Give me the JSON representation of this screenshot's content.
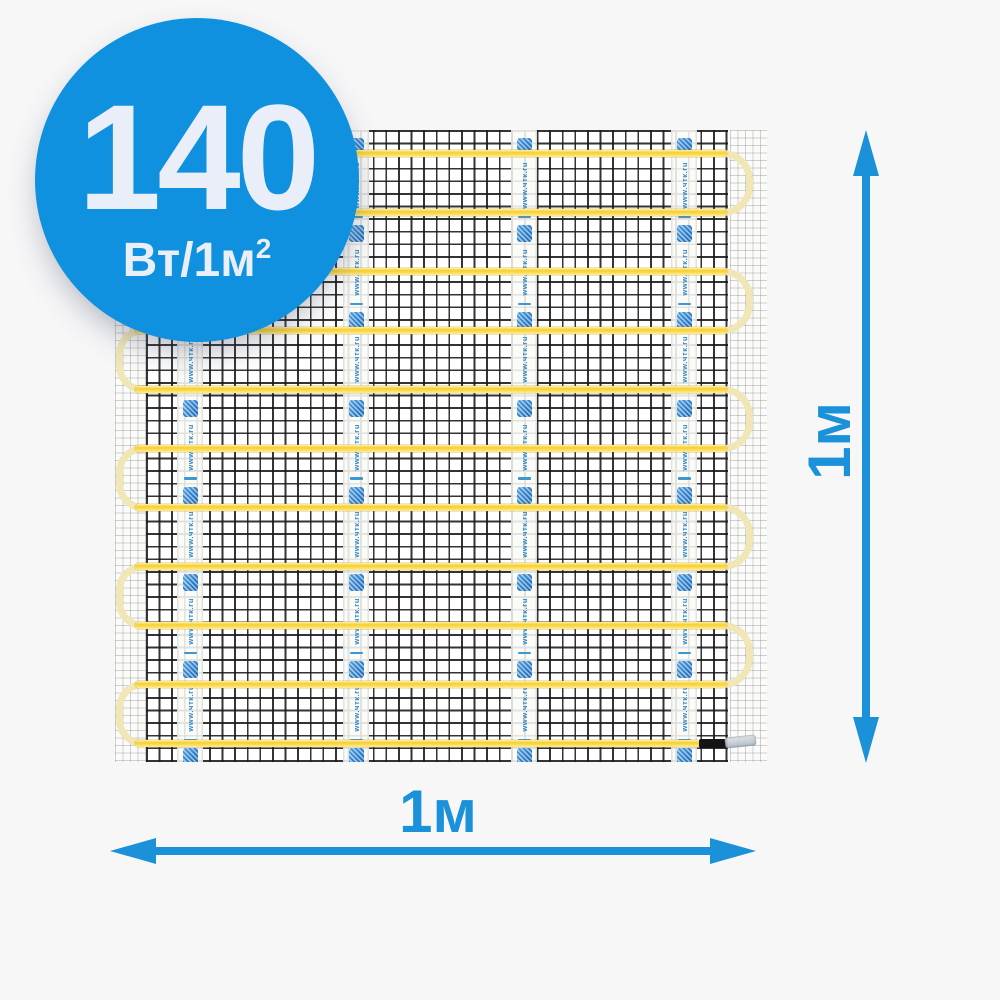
{
  "badge": {
    "value": "140",
    "unit_base": "Вт/1м",
    "unit_sup": "2",
    "bg_color": "#0f91e0",
    "text_color": "#e9eef8"
  },
  "dimensions": {
    "height_label": "1м",
    "width_label": "1м",
    "arrow_color": "#1a91d8"
  },
  "mat": {
    "tape_text": "www.чтк.ru",
    "tape_count": 4,
    "tape_units_per_strip": 8,
    "cable_rows": 11,
    "cable_color": "#f7cf2e",
    "turn_color": "#f1e6b6",
    "mesh_color": "#181818",
    "icons": {
      "tape_logo": "brand-logo-icon",
      "cable_end": "cable-end-cap"
    }
  }
}
